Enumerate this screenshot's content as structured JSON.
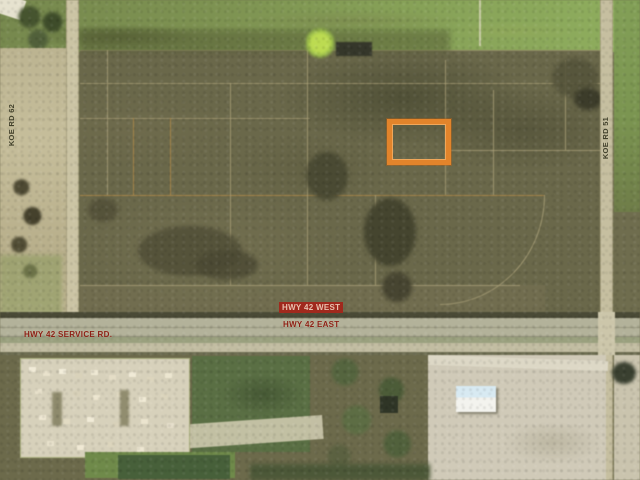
{
  "title": "Aerial parcel map with highlighted lot",
  "map": {
    "type": "aerial-photo-parcel-map",
    "roads": {
      "left_vertical": "KOE RD 62",
      "right_vertical": "KOE RD 51",
      "highway_west": "HWY 42 WEST",
      "highway_east": "HWY 42 EAST",
      "service_road": "HWY 42 SERVICE RD."
    },
    "highlight": {
      "name": "subject-parcel-outline",
      "shape": "rectangle",
      "color": "#E2842B"
    },
    "colors": {
      "label_red": "#8C1F14",
      "hwy_west_badge_bg": "#A0291D",
      "hwy_west_badge_text": "#E9C0AE",
      "road_label_dark": "#33331F",
      "field_olive": "#6A684A",
      "road_tan": "#CBC4A4",
      "industrial_yard": "#D7D1BB",
      "green_field": "#5A6F44"
    }
  }
}
